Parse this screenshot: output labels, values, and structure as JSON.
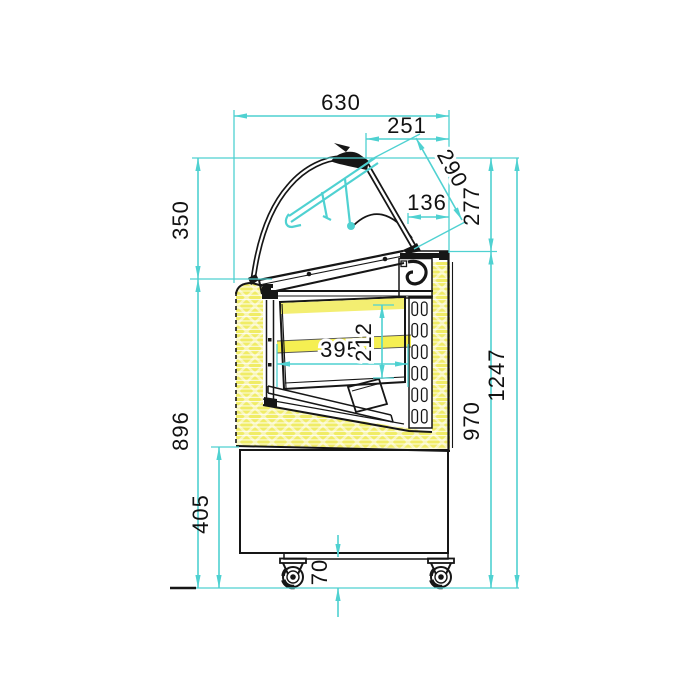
{
  "meta": {
    "description": "Side cross-section technical drawing of a curved-glass refrigerated display case with dimension lines",
    "units": "mm"
  },
  "colors": {
    "dimension_lines": "#4fd1d1",
    "insulation_fill": "#f0ec66",
    "insulation_hatch": "#f9f6bb",
    "highlight_band": "#f5ef52",
    "linework": "#161616",
    "background": "#ffffff"
  },
  "dims": {
    "d630": "630",
    "d251": "251",
    "d290": "290",
    "d136": "136",
    "d277": "277",
    "d350": "350",
    "d395": "395",
    "d212": "212",
    "d1247": "1247",
    "d970": "970",
    "d896": "896",
    "d405": "405",
    "d70": "70"
  }
}
